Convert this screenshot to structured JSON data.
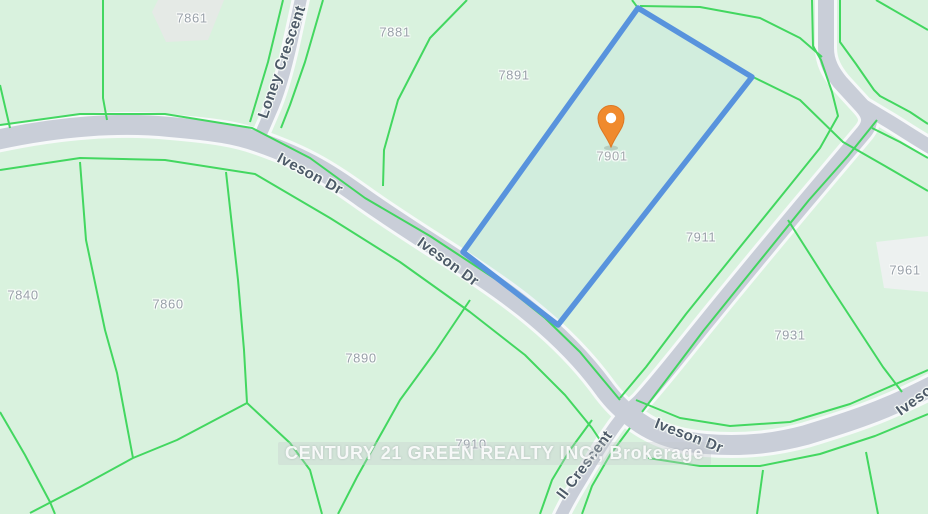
{
  "map": {
    "watermark": "CENTURY 21 GREEN REALTY INC., Brokerage",
    "pin": {
      "label": "7901"
    },
    "parcels": [
      {
        "id": "7861"
      },
      {
        "id": "7881"
      },
      {
        "id": "7891"
      },
      {
        "id": "7911"
      },
      {
        "id": "7961"
      },
      {
        "id": "7931"
      },
      {
        "id": "7840"
      },
      {
        "id": "7860"
      },
      {
        "id": "7890"
      },
      {
        "id": "7910"
      }
    ],
    "roads": {
      "iveson": "Iveson Dr",
      "loney": "Loney Crescent",
      "crescent_partial": "ll Crescent"
    },
    "colors": {
      "background": "#d9f2de",
      "parcel_line": "#3bd65a",
      "road_fill": "#c9ced8",
      "road_casing": "#ffffff",
      "selected_parcel_outline": "#5893dd",
      "pin_fill": "#f08a2d",
      "parcel_label": "#99a1a9",
      "road_label": "#4d5a68",
      "building_patch": "#e6e9e6"
    }
  }
}
